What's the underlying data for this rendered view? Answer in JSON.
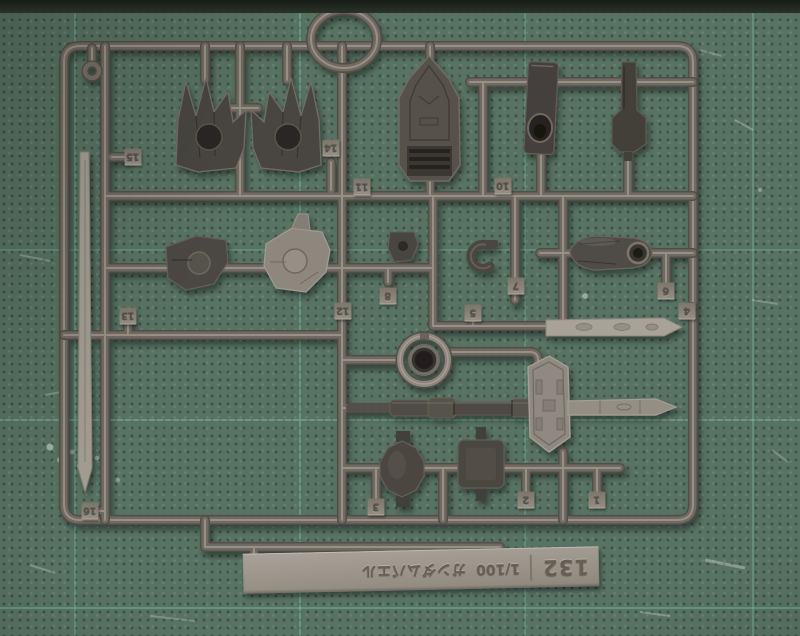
{
  "scene": {
    "subject": "plastic model kit runner on green cutting mat"
  },
  "label_plate": {
    "code": "132",
    "scale": "1/100",
    "kit_name": "ガンダムバエル"
  },
  "part_tags": [
    {
      "label": "15",
      "x": 133,
      "y": 157
    },
    {
      "label": "14",
      "x": 331,
      "y": 148
    },
    {
      "label": "11",
      "x": 362,
      "y": 187
    },
    {
      "label": "10",
      "x": 503,
      "y": 186
    },
    {
      "label": "13",
      "x": 128,
      "y": 316
    },
    {
      "label": "12",
      "x": 343,
      "y": 311
    },
    {
      "label": "8",
      "x": 388,
      "y": 296
    },
    {
      "label": "7",
      "x": 516,
      "y": 286
    },
    {
      "label": "5",
      "x": 473,
      "y": 313
    },
    {
      "label": "6",
      "x": 666,
      "y": 291
    },
    {
      "label": "4",
      "x": 687,
      "y": 311
    },
    {
      "label": "16",
      "x": 90,
      "y": 511
    },
    {
      "label": "3",
      "x": 376,
      "y": 507
    },
    {
      "label": "2",
      "x": 526,
      "y": 500
    },
    {
      "label": "1",
      "x": 597,
      "y": 500
    }
  ],
  "colors": {
    "mat": "#587263",
    "mat_grid_line": "#7ed1b8",
    "runner_plastic": "#716a62",
    "dark_part": "#46423e",
    "light_part": "#a39d94",
    "label_plate": "#9c968c",
    "tag": "#878176"
  }
}
